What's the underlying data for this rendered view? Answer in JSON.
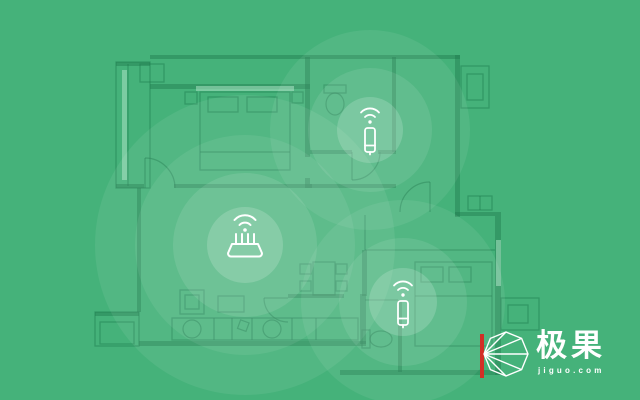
{
  "canvas": {
    "background_color": "#45B27A",
    "plan_line_color": "#1E7B4E",
    "signal_color": "#FFFFFF"
  },
  "scene": {
    "kind": "wifi-coverage-floorplan-illustration",
    "devices": [
      {
        "id": "wifi-extender-top",
        "type": "extender",
        "icon": "wifi-extender-icon"
      },
      {
        "id": "wifi-router",
        "type": "router",
        "icon": "wifi-router-icon"
      },
      {
        "id": "wifi-extender-bottom",
        "type": "extender",
        "icon": "wifi-extender-icon"
      }
    ]
  },
  "logo": {
    "brand_text": "极果",
    "domain_text": "jiguo.com",
    "icon": "jiguo-polygon-icon",
    "accent_color": "#D22F27",
    "text_color": "#FFFFFF"
  }
}
